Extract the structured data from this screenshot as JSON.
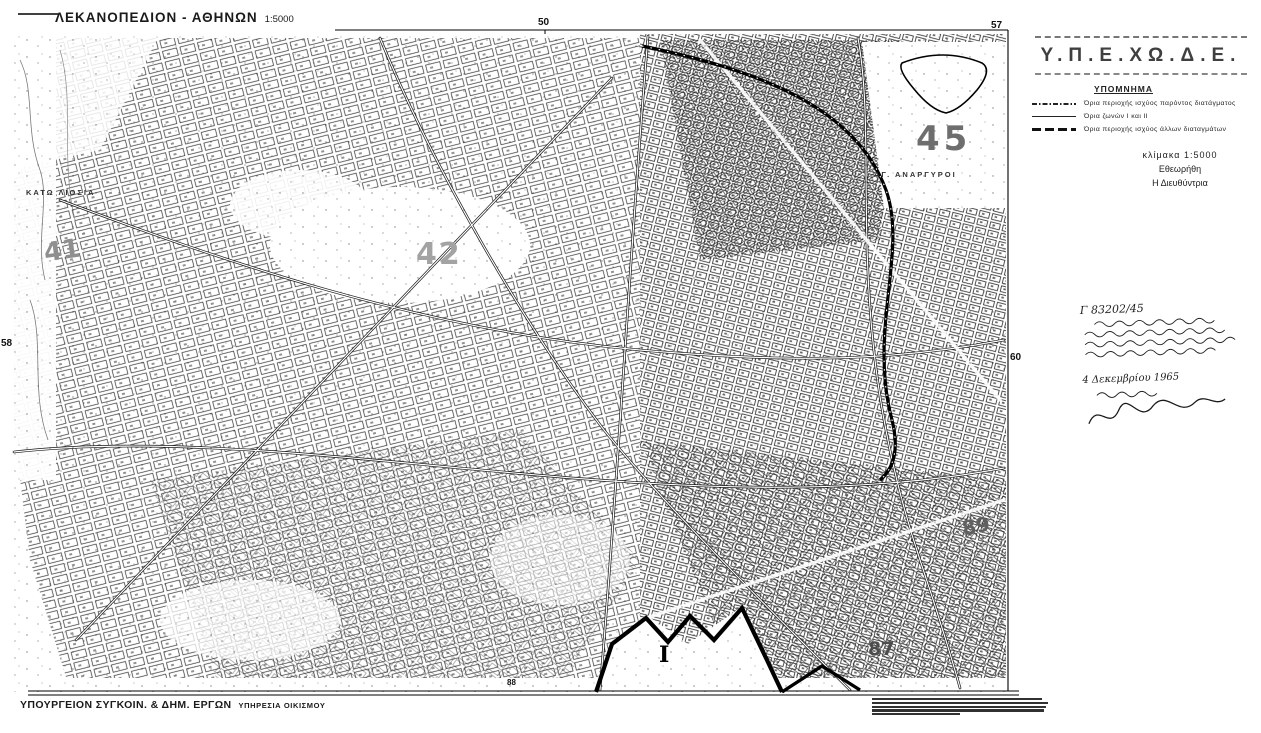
{
  "map": {
    "title": "ΛΕΚΑΝΟΠΕΔΙΟΝ - ΑΘΗΝΩΝ",
    "title_scale": "1:5000",
    "edge_ticks": [
      {
        "label": "50",
        "edge": "top"
      },
      {
        "label": "57",
        "edge": "top-right"
      },
      {
        "label": "58",
        "edge": "left"
      },
      {
        "label": "60",
        "edge": "right"
      },
      {
        "label": "88",
        "edge": "bottom"
      }
    ],
    "sheet_numbers": [
      {
        "label": "41"
      },
      {
        "label": "42"
      },
      {
        "label": "45"
      },
      {
        "label": "87"
      },
      {
        "label": "89"
      }
    ],
    "place_labels": [
      {
        "label": "ΚΑΤΩ ΛΙΟΣΙΑ"
      },
      {
        "label": "ΑΓ. ΑΝΑΡΓΥΡΟΙ"
      }
    ],
    "zone_label": "I"
  },
  "panel": {
    "stamp": "Υ.Π.Ε.ΧΩ.Δ.Ε.",
    "legend_title": "ΥΠΟΜΝΗΜΑ",
    "legend_items": [
      {
        "style": "dash-dot",
        "label": "Όρια περιοχής ισχύος παρόντος διατάγματος"
      },
      {
        "style": "solid",
        "label": "Όρια ζωνών Ι και ΙΙ"
      },
      {
        "style": "long-dash",
        "label": "Όρια περιοχής ισχύος άλλων διαταγμάτων"
      }
    ],
    "scale_note": "κλίμακα 1:5000",
    "approved": "Εθεωρήθη",
    "approver": "Η Διευθύντρια",
    "handwritten": {
      "ref": "Γ 83202/45",
      "date": "4 Δεκεμβρίου 1965"
    }
  },
  "footer": {
    "credit_main": "ΥΠΟΥΡΓΕΙΟΝ ΣΥΓΚΟΙΝ. & ΔΗΜ. ΕΡΓΩΝ",
    "credit_sub": "ΥΠΗΡΕΣΙΑ ΟΙΚΙΣΜΟΥ"
  },
  "colors": {
    "paper": "#ffffff",
    "ink": "#1a1a1a",
    "sheet_number_gray": "#8f8f8f"
  }
}
